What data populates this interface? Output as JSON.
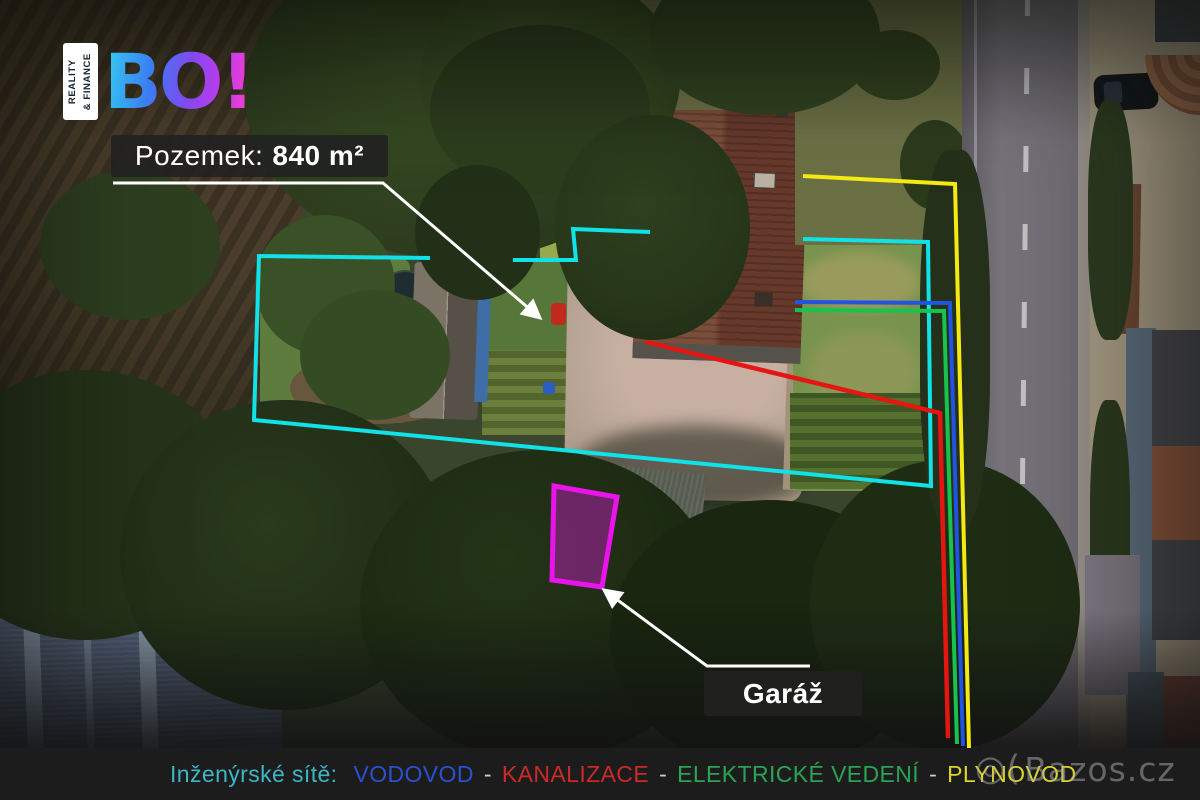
{
  "logo": {
    "brand": "BO!",
    "tagline": [
      "REALITY",
      "& FINANCE"
    ]
  },
  "annotations": {
    "area": {
      "prefix": "Pozemek:",
      "value": "840 m²"
    },
    "garage": "Garáž"
  },
  "legend": {
    "title": "Inženýrské sítě:",
    "title_color": "#3db6c6",
    "separator": "-",
    "items": [
      {
        "label": "VODOVOD",
        "color": "#2b50d0"
      },
      {
        "label": "KANALIZACE",
        "color": "#cc2a26"
      },
      {
        "label": "ELEKTRICKÉ VEDENÍ",
        "color": "#2aa355"
      },
      {
        "label": "PLYNOVOD",
        "color": "#d9d52b"
      }
    ]
  },
  "overlay": {
    "boundary": "#10e2e8",
    "water": "#2154e0",
    "sewer": "#e51512",
    "electric": "#18c24e",
    "gas": "#f4e912",
    "garage_stroke": "#ea14ea",
    "garage_fill": "rgba(214,26,214,0.42)"
  },
  "watermark": {
    "icon": "◎(",
    "text": "Bazos.cz"
  }
}
